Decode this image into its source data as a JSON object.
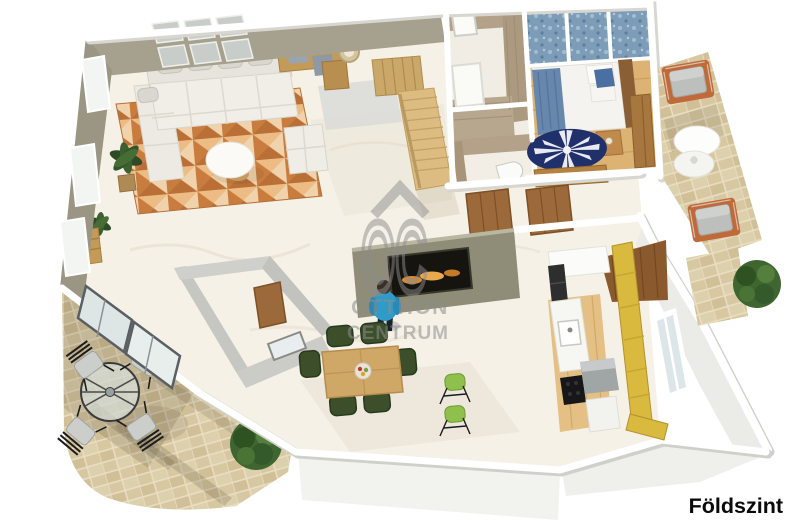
{
  "page": {
    "floor_label": "Földszint",
    "background_color": "#ffffff",
    "floor_label_color": "#0a0a0a"
  },
  "watermark": {
    "logo_text": "OC",
    "brand_line1": "OTTHON",
    "brand_line2": "CENTRUM",
    "color": "#8d8d8d"
  },
  "scene": {
    "type": "3d-floor-plan-render",
    "rooms": [
      "living-room",
      "dining-area",
      "kitchen",
      "hallway",
      "entry",
      "bedroom",
      "bathroom",
      "wc",
      "staircase",
      "left-terrace",
      "right-terrace"
    ],
    "furniture": [
      "corner-sofa",
      "coffee-table",
      "armchair-pouf",
      "area-rug",
      "desk-unit",
      "wall-clock",
      "potted-plants",
      "dining-table",
      "dining-chairs-green",
      "bar-stools-green",
      "kitchen-counter",
      "range-hood",
      "yellow-cabinets",
      "double-bed",
      "nightstand",
      "bedroom-rug",
      "wardrobe",
      "shower",
      "corner-sink",
      "interior-doors",
      "sliding-glass-doors",
      "terrace-round-table",
      "terrace-chairs",
      "outdoor-armchairs",
      "outdoor-side-table",
      "garden-bushes",
      "fireplace-tv",
      "human-figure"
    ]
  },
  "colors": {
    "wall_olive": "#a19d8a",
    "wall_white": "#ffffff",
    "floor_marble": "#f6f1e7",
    "bedroom_floor_wood": "#dcb372",
    "kitchen_floor_wood": "#e5c084",
    "dark_wood_floor": "#8a5a2e",
    "living_rug_terracotta": "#d98c4f",
    "bedroom_rug_navy": "#20306b",
    "terrace_stone": "#d8c8a2",
    "kitchen_cabinets_yellow": "#d9b93e",
    "sofa_cream": "#f0eee7",
    "dining_chair_green": "#3c4f2a",
    "bar_stool_green": "#8fbf4d",
    "bed_blue": "#6787ad",
    "curtain_blue": "#7d9cb8",
    "door_brown": "#9c6a3a",
    "outdoor_chair_terracotta": "#c06a3a",
    "figure_blue": "#2f9bc9",
    "plant_green": "#3f6631"
  }
}
